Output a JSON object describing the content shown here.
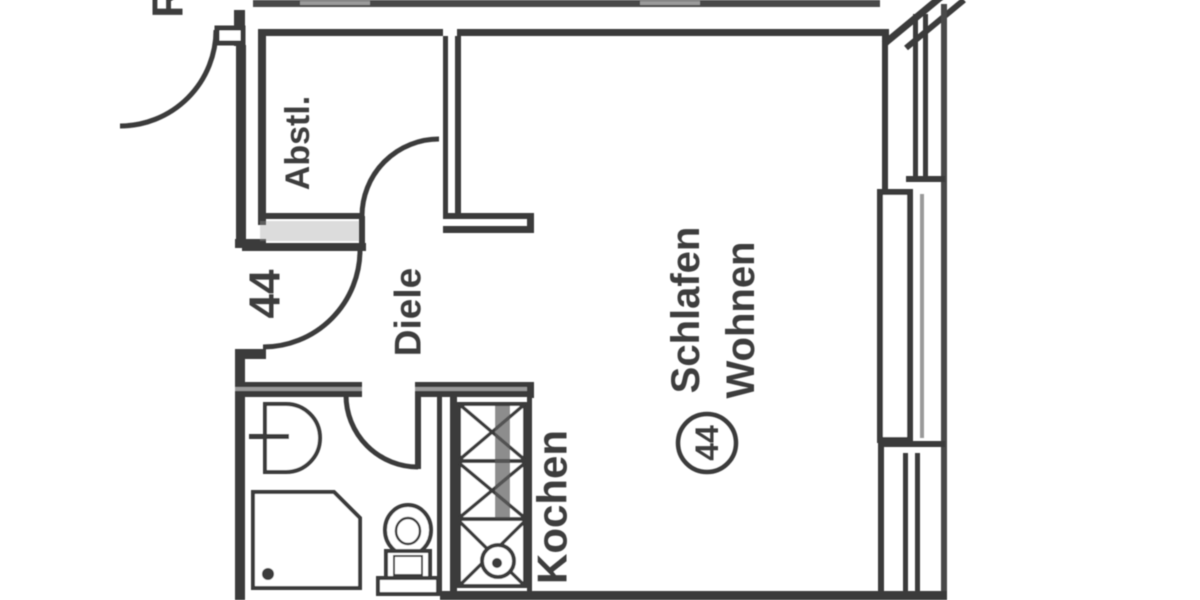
{
  "style": {
    "background": "#ffffff",
    "ink": "#3a3a3a",
    "light_ink": "#9a9a9a"
  },
  "labels": {
    "partial_room_top_left": "R",
    "storage_room": "Abstl.",
    "entrance_number": "44",
    "hallway": "Diele",
    "kitchen": "Kochen",
    "living_line1": "Schlafen",
    "living_line2": "Wohnen",
    "living_circle_number": "44"
  }
}
